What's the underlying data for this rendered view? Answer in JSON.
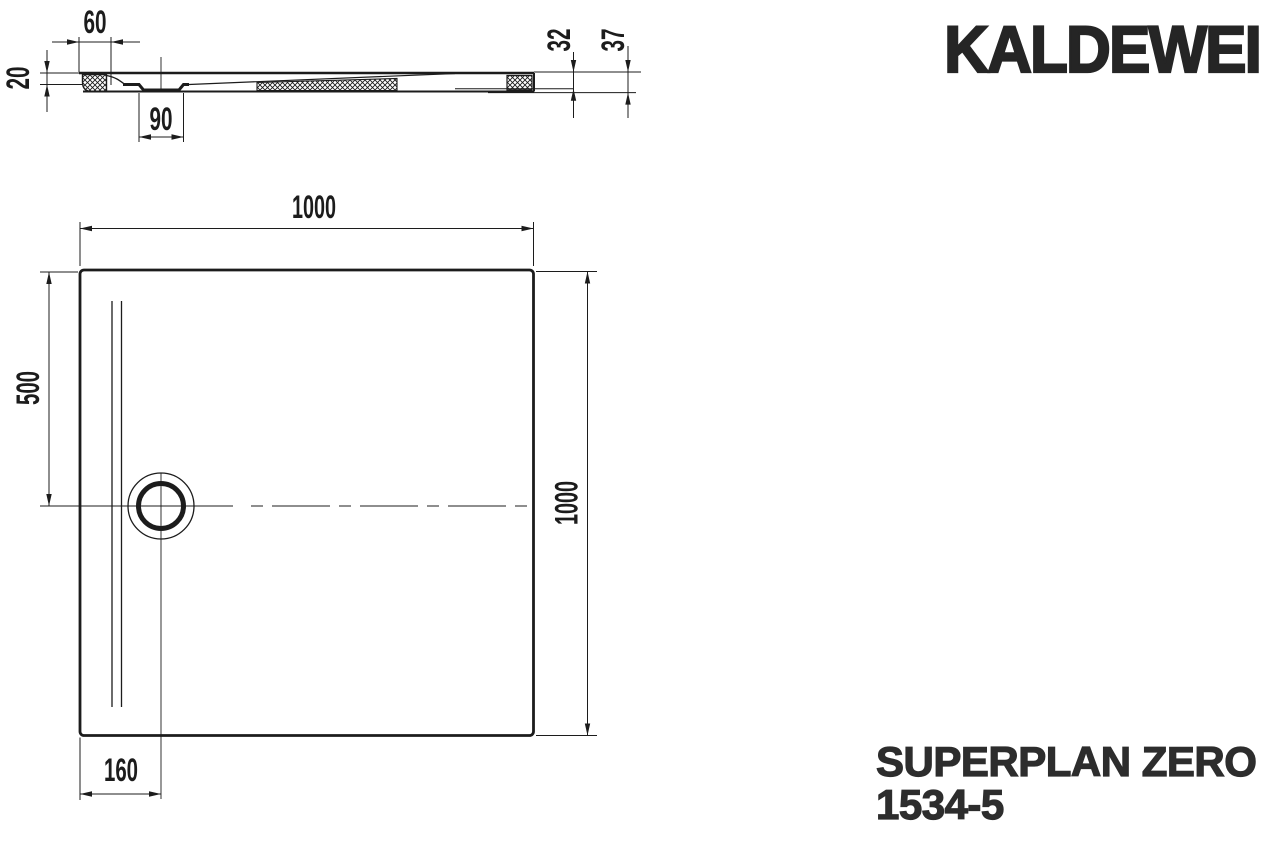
{
  "brand": {
    "logo": "KALDEWEI"
  },
  "product": {
    "name": "SUPERPLAN ZERO",
    "model": "1534-5"
  },
  "dimensions": {
    "section": {
      "edge_width": "60",
      "front_height": "20",
      "drain_width": "90",
      "height_inner": "32",
      "height_total": "37"
    },
    "plan": {
      "width_top": "1000",
      "height_right": "1000",
      "drain_from_top": "500",
      "drain_from_left": "160"
    }
  },
  "colors": {
    "line": "#1c1c1c",
    "brand_text": "#252525"
  }
}
